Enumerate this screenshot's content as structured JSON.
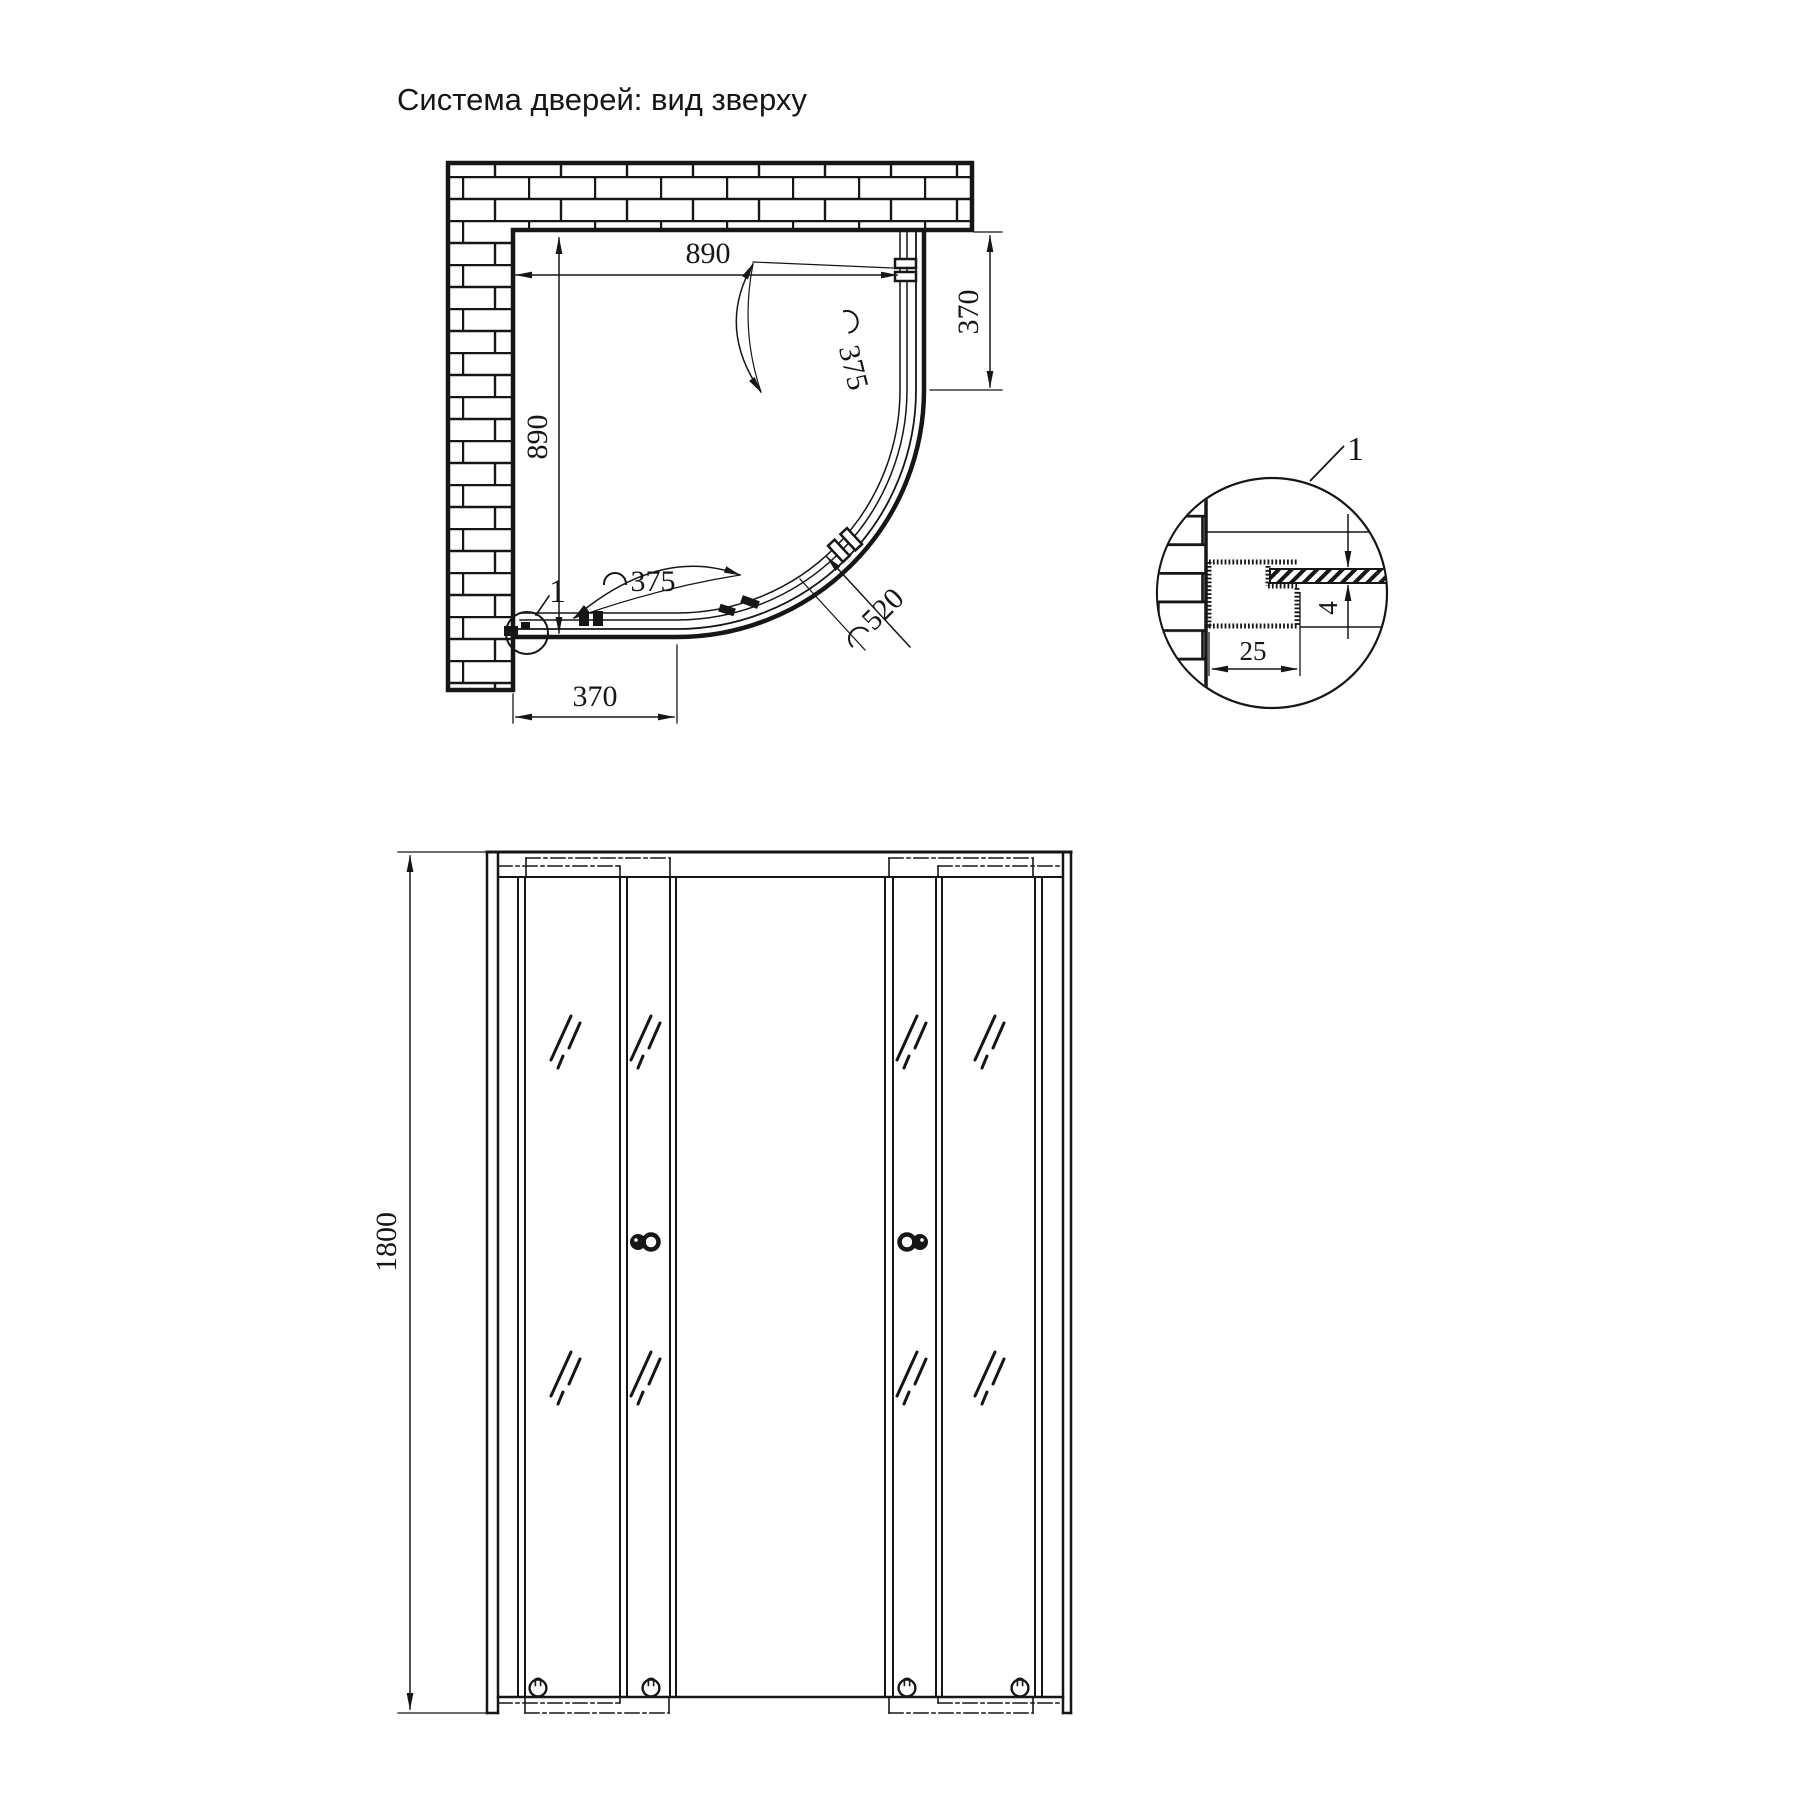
{
  "title": "Система дверей: вид зверху",
  "colors": {
    "line": "#161616",
    "background": "#ffffff"
  },
  "top_view": {
    "dim_width_top": "890",
    "dim_height_left": "890",
    "dim_right_side": "370",
    "dim_bottom": "370",
    "dim_arc_door_upper": "375",
    "dim_arc_door_lower": "375",
    "dim_arc_opening": "520",
    "detail_marker": "1"
  },
  "detail_view": {
    "marker": "1",
    "dim_profile_depth": "25",
    "dim_glass_thickness": "4"
  },
  "front_view": {
    "dim_height": "1800"
  }
}
